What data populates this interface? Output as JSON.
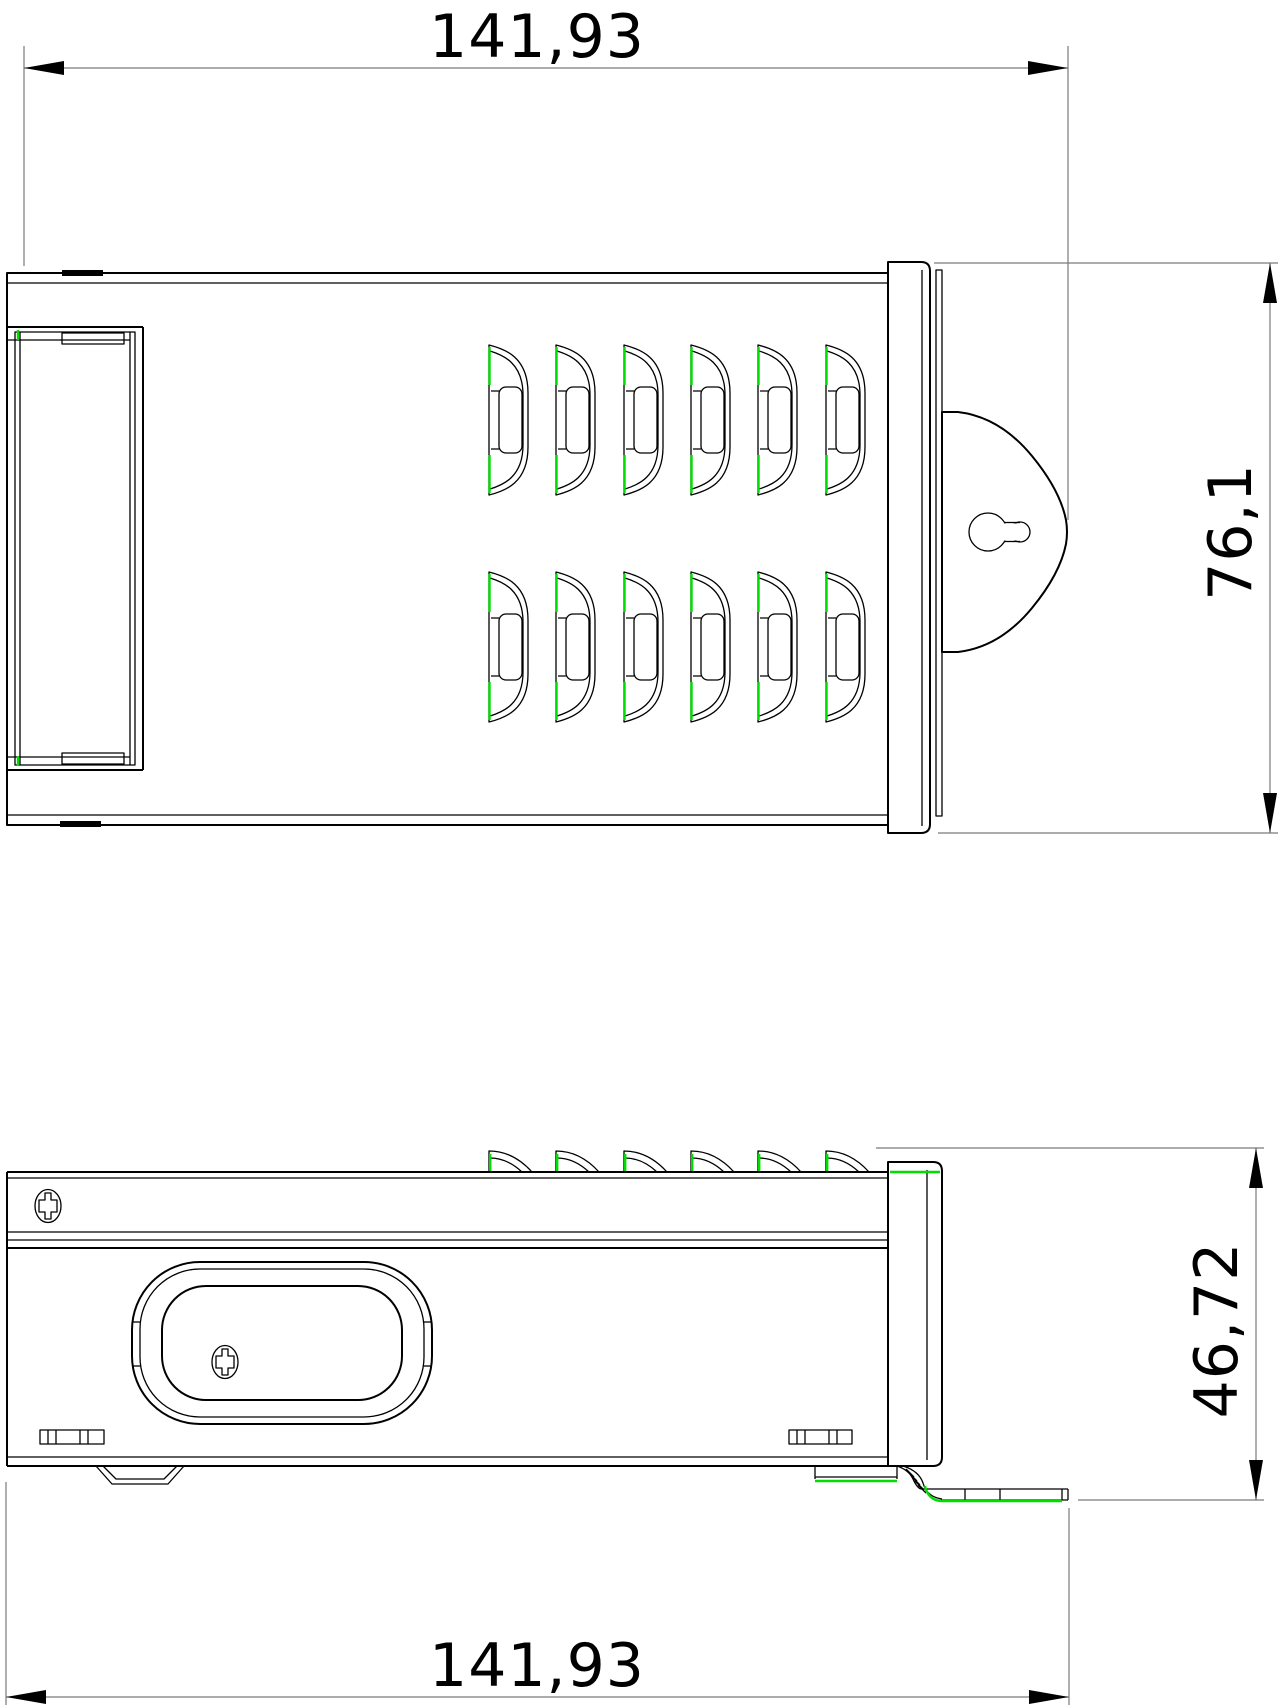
{
  "drawing_title": "power-supply-enclosure-two-view-drawing",
  "dimensions": {
    "top_width": {
      "value": "141,93"
    },
    "overall_height": {
      "value": "76,1"
    },
    "side_height": {
      "value": "46,72"
    },
    "bottom_width": {
      "value": "141,93"
    }
  },
  "colors": {
    "line": "#000000",
    "dimension_line": "#7a7a7a",
    "sheet_edge_highlight": "#00dd00",
    "background": "#ffffff"
  },
  "drawing": {
    "vent_columns": [
      489,
      556,
      624,
      691,
      758,
      826
    ],
    "vent_rows": [
      341,
      568
    ],
    "vent_width": 39,
    "vent_height": 158,
    "fin_columns": [
      489,
      556,
      624,
      691,
      758,
      826
    ],
    "fin_base_y": 1172,
    "fin_top_y": 1151,
    "fin_width": 43
  }
}
